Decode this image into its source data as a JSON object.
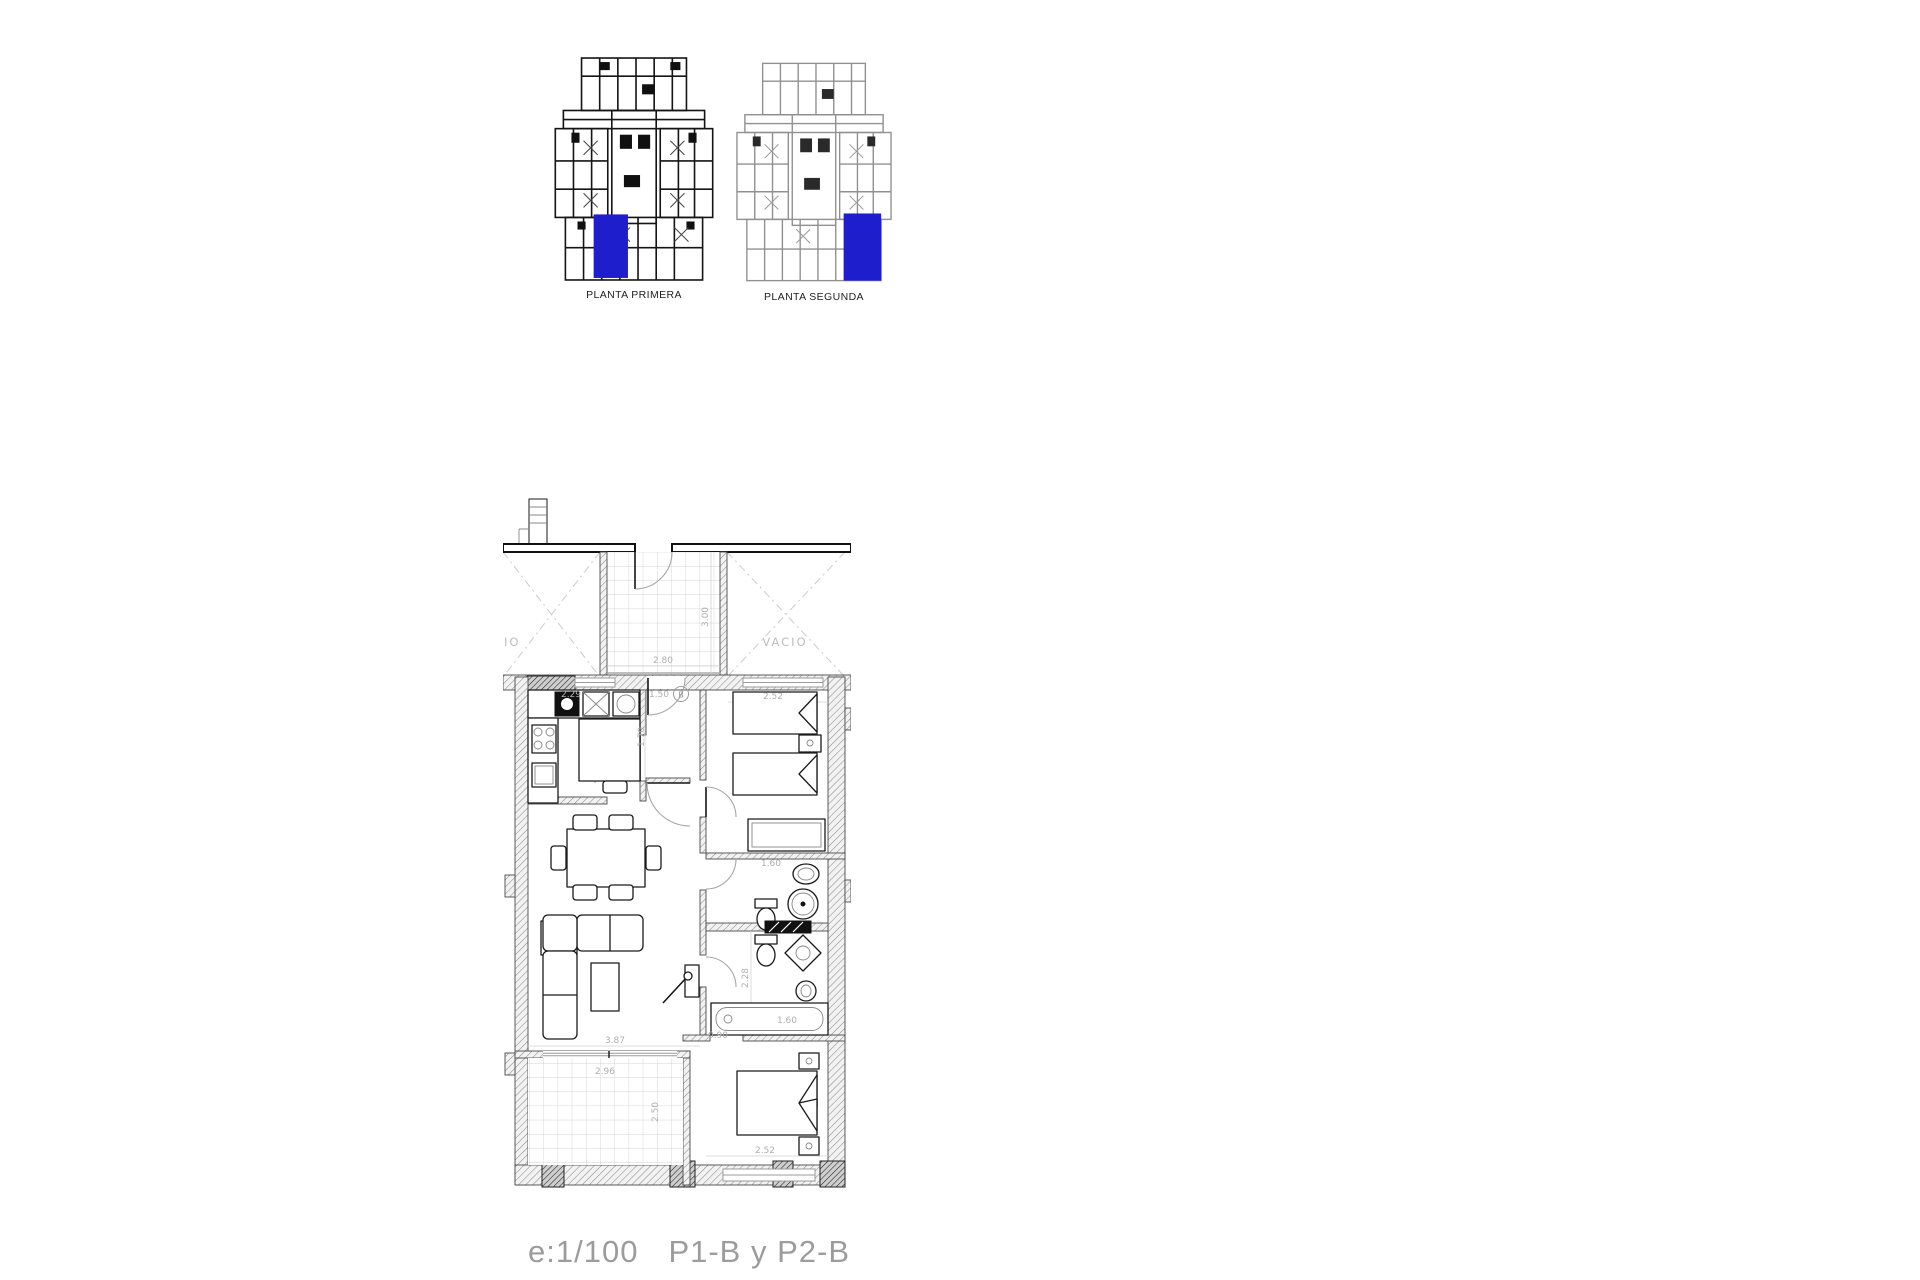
{
  "overview": {
    "highlight_color": "#1e1ecd",
    "plans": [
      {
        "label": "PLANTA PRIMERA"
      },
      {
        "label": "PLANTA SEGUNDA"
      }
    ]
  },
  "floorplan": {
    "void_left_label": "IO",
    "void_right_label": "VACIO",
    "entry_badge": "B",
    "dims": {
      "terrace_top_width": "2.80",
      "terrace_top_depth": "3.00",
      "bedroom1_width": "2.52",
      "kitchen_width": "2.29",
      "entry_width": "1.50",
      "entry_depth": "1.70",
      "bath1_basin": "1.60",
      "bath2_depth": "2.28",
      "hall_width": "0.90",
      "living_width": "3.87",
      "bathtub_width": "1.60",
      "terrace_bottom_width": "2.96",
      "terrace_bottom_depth": "2.50",
      "bedroom2_width": "2.52"
    }
  },
  "caption": {
    "scale": "e:1/100",
    "sheets": "P1-B y P2-B"
  }
}
